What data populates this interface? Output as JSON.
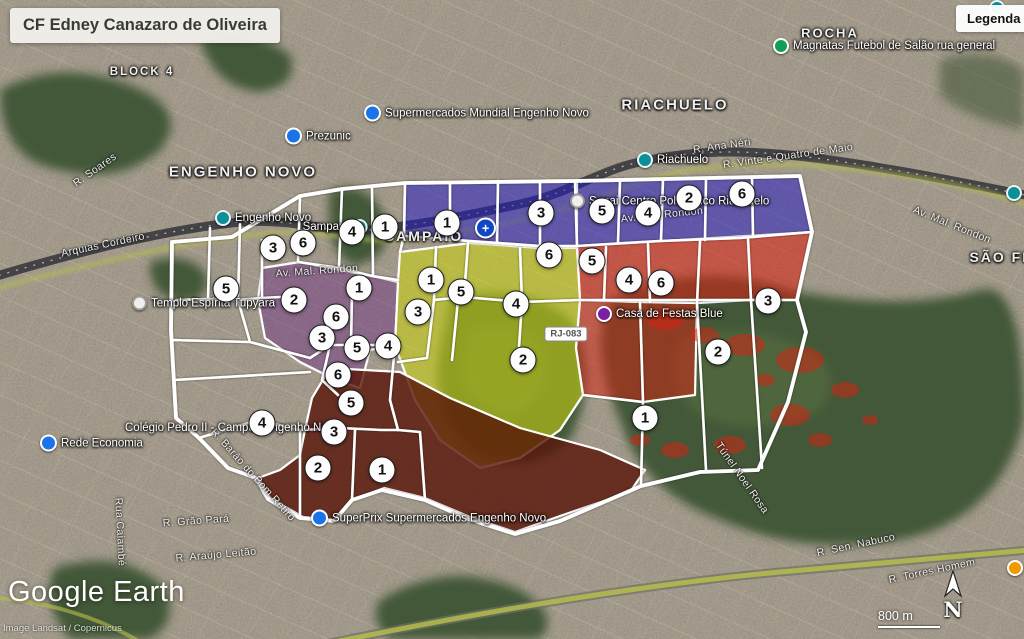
{
  "title": "CF Edney Canazaro de Oliveira",
  "legend": {
    "label": "Legenda"
  },
  "branding": {
    "logo": "Google Earth",
    "attribution": "Image Landsat / Copernicus"
  },
  "scale": {
    "label": "800 m"
  },
  "compass": {
    "label": "N"
  },
  "road_shield": {
    "label": "RJ-083",
    "x": 566,
    "y": 334
  },
  "colors": {
    "team_blue": "#2016c8",
    "team_red": "#dc1f10",
    "team_purple": "#6d2d86",
    "team_yellow": "#c9d313",
    "team_maroon": "#571407",
    "boundary": "#ffffff"
  },
  "map": {
    "place_labels": [
      {
        "text": "ENGENHO NOVO",
        "x": 243,
        "y": 172,
        "size": 15
      },
      {
        "text": "SAMPAIO",
        "x": 424,
        "y": 236,
        "size": 14
      },
      {
        "text": "RIACHUELO",
        "x": 675,
        "y": 105,
        "size": 15
      },
      {
        "text": "ROCHA",
        "x": 830,
        "y": 33,
        "size": 13
      },
      {
        "text": "SÃO FRAN",
        "x": 1014,
        "y": 257,
        "size": 14
      },
      {
        "text": "BLOCK 4",
        "x": 142,
        "y": 72,
        "size": 11.5
      }
    ],
    "street_labels": [
      {
        "text": "Arquias Cordeiro",
        "x": 103,
        "y": 245,
        "rot": -12
      },
      {
        "text": "R. Soares",
        "x": 95,
        "y": 170,
        "rot": -35
      },
      {
        "text": "Av. Mal. Rondon",
        "x": 317,
        "y": 271,
        "rot": -4
      },
      {
        "text": "Av. Mal. Rondon",
        "x": 662,
        "y": 215,
        "rot": -6
      },
      {
        "text": "Av. Mal. Rondon",
        "x": 952,
        "y": 225,
        "rot": 22
      },
      {
        "text": "R. Vinte e Quatro de Maio",
        "x": 788,
        "y": 156,
        "rot": -8
      },
      {
        "text": "R. Ana Néri",
        "x": 722,
        "y": 146,
        "rot": -8
      },
      {
        "text": "R. Barão do Bom Retiro",
        "x": 253,
        "y": 475,
        "rot": 48
      },
      {
        "text": "Rua Caiambé",
        "x": 120,
        "y": 532,
        "rot": 87
      },
      {
        "text": "R. Grão Pará",
        "x": 196,
        "y": 521,
        "rot": -4
      },
      {
        "text": "R. Araújo Leitão",
        "x": 216,
        "y": 555,
        "rot": -5
      },
      {
        "text": "R. Sen. Nabuco",
        "x": 856,
        "y": 545,
        "rot": -12
      },
      {
        "text": "R. Torres Homem",
        "x": 932,
        "y": 571,
        "rot": -12
      },
      {
        "text": "Túnel Noel Rosa",
        "x": 742,
        "y": 478,
        "rot": 55
      }
    ],
    "poi_labels": [
      {
        "icon": "blue-pin",
        "text": "Supermercados Mundial Engenho Novo",
        "x": 364,
        "y": 113
      },
      {
        "icon": "blue-pin",
        "text": "Prezunic",
        "x": 285,
        "y": 136
      },
      {
        "icon": "station",
        "text": "Engenho Novo",
        "x": 215,
        "y": 218
      },
      {
        "icon": "station",
        "text": "Sampaio",
        "x": 368,
        "y": 227,
        "side": "left"
      },
      {
        "icon": "station",
        "text": "Riachuelo",
        "x": 637,
        "y": 160
      },
      {
        "icon": "station",
        "text": "São Fran",
        "x": 1006,
        "y": 193
      },
      {
        "icon": "station",
        "text": "",
        "x": 989,
        "y": 8
      },
      {
        "icon": "white-dot",
        "text": "Templo Espírita Tupyara",
        "x": 132,
        "y": 303
      },
      {
        "icon": "white-dot",
        "text": "Senai Centro Politécnico Riachuelo",
        "x": 570,
        "y": 201
      },
      {
        "icon": "blue-pin",
        "text": "Rede Economia",
        "x": 40,
        "y": 443
      },
      {
        "icon": "none",
        "text": "Colégio Pedro II -  Campus Engenho Novo",
        "x": 125,
        "y": 428
      },
      {
        "icon": "blue-pin",
        "text": "SuperPrix Supermercados Engenho Novo",
        "x": 311,
        "y": 518
      },
      {
        "icon": "purple-pin",
        "text": "Casa de Festas Blue",
        "x": 596,
        "y": 314
      },
      {
        "icon": "green-dot",
        "text": "Magnatas Futebol de Salão rua general",
        "x": 773,
        "y": 46
      },
      {
        "icon": "orange-dot",
        "text": "Fabe",
        "x": 1007,
        "y": 568
      },
      {
        "icon": "health",
        "text": "",
        "x": 475,
        "y": 228
      }
    ],
    "micro_area_markers": [
      {
        "n": "3",
        "x": 273,
        "y": 248
      },
      {
        "n": "6",
        "x": 303,
        "y": 243
      },
      {
        "n": "4",
        "x": 352,
        "y": 232
      },
      {
        "n": "1",
        "x": 385,
        "y": 227
      },
      {
        "n": "5",
        "x": 226,
        "y": 289
      },
      {
        "n": "2",
        "x": 294,
        "y": 300
      },
      {
        "n": "1",
        "x": 359,
        "y": 288
      },
      {
        "n": "6",
        "x": 336,
        "y": 317
      },
      {
        "n": "3",
        "x": 322,
        "y": 338
      },
      {
        "n": "5",
        "x": 357,
        "y": 348
      },
      {
        "n": "4",
        "x": 388,
        "y": 346
      },
      {
        "n": "6",
        "x": 338,
        "y": 375
      },
      {
        "n": "5",
        "x": 351,
        "y": 403
      },
      {
        "n": "4",
        "x": 262,
        "y": 423
      },
      {
        "n": "3",
        "x": 334,
        "y": 432
      },
      {
        "n": "2",
        "x": 318,
        "y": 468
      },
      {
        "n": "1",
        "x": 382,
        "y": 470
      },
      {
        "n": "3",
        "x": 418,
        "y": 312
      },
      {
        "n": "1",
        "x": 431,
        "y": 280
      },
      {
        "n": "5",
        "x": 461,
        "y": 292
      },
      {
        "n": "4",
        "x": 516,
        "y": 304
      },
      {
        "n": "2",
        "x": 523,
        "y": 360
      },
      {
        "n": "1",
        "x": 447,
        "y": 223
      },
      {
        "n": "3",
        "x": 541,
        "y": 213
      },
      {
        "n": "5",
        "x": 602,
        "y": 211
      },
      {
        "n": "4",
        "x": 648,
        "y": 213
      },
      {
        "n": "2",
        "x": 689,
        "y": 198
      },
      {
        "n": "6",
        "x": 742,
        "y": 194
      },
      {
        "n": "6",
        "x": 549,
        "y": 255
      },
      {
        "n": "5",
        "x": 592,
        "y": 261
      },
      {
        "n": "4",
        "x": 629,
        "y": 280
      },
      {
        "n": "6",
        "x": 661,
        "y": 283
      },
      {
        "n": "3",
        "x": 768,
        "y": 301
      },
      {
        "n": "2",
        "x": 718,
        "y": 352
      },
      {
        "n": "1",
        "x": 645,
        "y": 418
      }
    ]
  }
}
